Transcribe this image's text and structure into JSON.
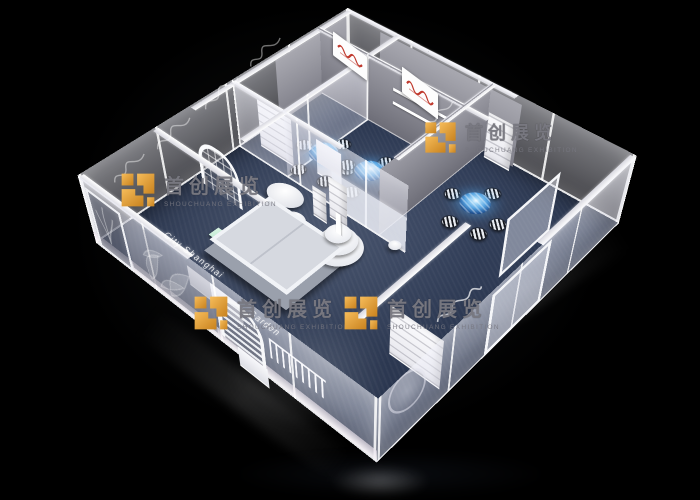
{
  "scene": {
    "description": "3D rendering of a square exhibition booth seen from above on a black background",
    "background": "#000000"
  },
  "palette": {
    "carpet_navy": "#2b3750",
    "glass_tint": "#e6e6f2",
    "gray_wall": "#85858e",
    "white_trim": "#f4f5f7",
    "table_glow_blue": "#4f9ede",
    "logo_orange": "#eda33c",
    "mint_bench": "#aadfc2",
    "sign_red": "#c03a2e"
  },
  "watermark": {
    "brand": "首创展览",
    "subtitle": "SHOUCHUANG EXHIBITION"
  },
  "wall_text": {
    "fascia_script": "City Shanghai",
    "fascia_script_2": "Garden"
  },
  "furniture": {
    "glowing_round_tables": 3,
    "striped_bistro_chairs": 14,
    "white_oval_tables": 3,
    "tiered_reception_counter": 1,
    "display_platform": 1,
    "shelving_units": 6,
    "arched_windows": 2,
    "back_wall_signs": 2
  }
}
